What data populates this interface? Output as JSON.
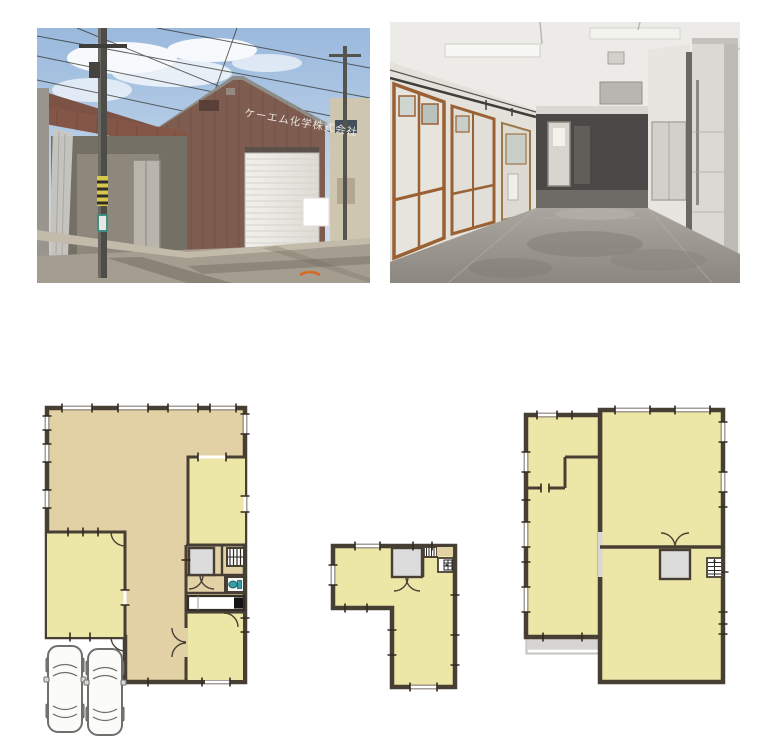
{
  "page": {
    "title": "Property listing image — photos and floor plans",
    "background": "#ffffff"
  },
  "photos": {
    "exterior": {
      "label": "building-exterior-photo",
      "signage_text": "ケーエム化学株式会社",
      "colors": {
        "sky": "#a3bfdf",
        "cloud": "#ffffff",
        "building_wall": "#7e5c50",
        "awning": "#7c5244",
        "shutter": "#edebe6",
        "pole": "#4e4c48",
        "road": "#a59e90",
        "apron": "#c3bbaa",
        "sign_board": "#ffffff"
      }
    },
    "interior": {
      "label": "warehouse-interior-photo",
      "colors": {
        "ceiling": "#ecebe7",
        "left_wall": "#e3e1da",
        "wood_frame": "#9a6134",
        "back_opening": "#4a4947",
        "bright_door": "#d7d5cd",
        "pillar": "#dbd9d3",
        "floor": "#9b978f"
      }
    }
  },
  "floorplans": {
    "colors": {
      "wall": "#483f34",
      "area_tan": "#e2d1a5",
      "room_yellow": "#ece7a6",
      "room_gray": "#dcdcdc",
      "fixture_white": "#ffffff",
      "toilet_teal": "#35a0a8",
      "walkway_gray": "#d6d5d1"
    },
    "plans": [
      {
        "id": "floor-plan-1",
        "label": "first-floor-plan",
        "icons": [
          "staircase-icon",
          "toilet-icon",
          "kitchen-counter-icon",
          "stove-icon",
          "door-arc-icon",
          "car-icon",
          "car-icon"
        ]
      },
      {
        "id": "floor-plan-2",
        "label": "second-floor-plan",
        "icons": [
          "staircase-icon",
          "sink-icon",
          "double-door-icon"
        ]
      },
      {
        "id": "floor-plan-3",
        "label": "third-floor-plan",
        "icons": [
          "staircase-icon",
          "double-door-icon",
          "walkway-strip"
        ]
      }
    ]
  }
}
